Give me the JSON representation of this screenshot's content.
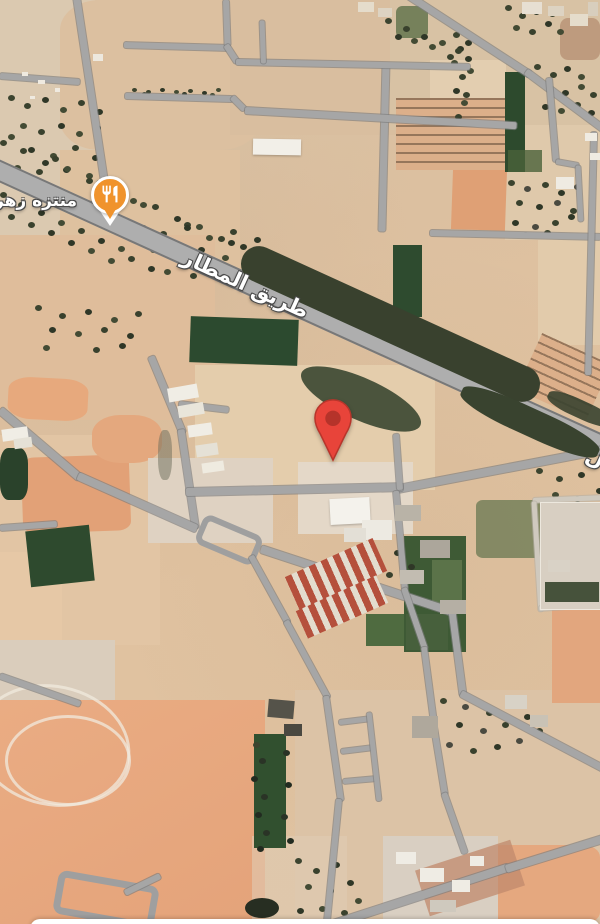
{
  "map": {
    "view": "satellite",
    "labels": {
      "road_main": "طريق المطار",
      "road_fragment_right_edge": "ل",
      "poi": "منتزه زهر"
    },
    "markers": {
      "poi": {
        "icon": "restaurant-icon",
        "pin_color": "#F0932C"
      },
      "destination": {
        "icon": "map-pin-icon",
        "pin_color": "#E8443A",
        "pin_inner_color": "#B5332A"
      }
    },
    "colors": {
      "road": "#A6A6A6",
      "highway": "#AEAEAE",
      "desert": "#DCC2A2",
      "salmon_field": "#E8A97E",
      "green_field": "#2C4A2F",
      "trees": "#3C442F",
      "label_text": "#FFFFFF",
      "label_outline": "#4A4A4A"
    }
  }
}
